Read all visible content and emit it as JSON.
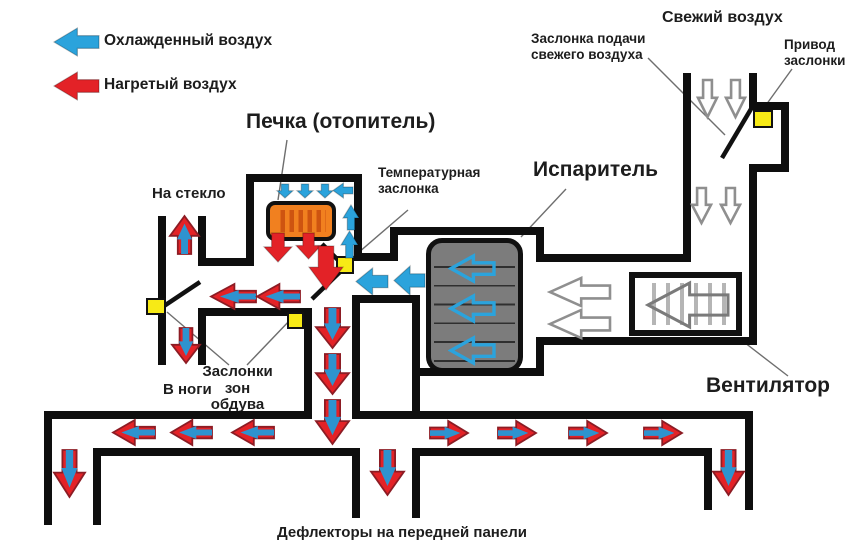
{
  "colors": {
    "wall": "#0e0e0e",
    "blue": "#2ba3dc",
    "red": "#e32227",
    "core_blue": "#2e93cf",
    "duo_edge": "#8c1c24",
    "yellow": "#f7ea16",
    "orange": "#f1801f",
    "orange_stripe": "#ce5410",
    "evap_gray": "#7c7c7c",
    "grille_gray": "#b5b5b5",
    "outline_gray": "#8f8f8f",
    "fan_arrow_gray": "#7a7a7a",
    "pointer_gray": "#6e6e6e",
    "flap_black": "#111111"
  },
  "legend": {
    "cold": "Охлажденный воздух",
    "hot": "Нагретый воздух"
  },
  "labels": {
    "heater_title": "Печка (отопитель)",
    "temp_damper": [
      "Температурная",
      "заслонка"
    ],
    "evaporator_title": "Испаритель",
    "fresh_air": "Свежий воздух",
    "fresh_damper": [
      "Заслонка подачи",
      "свежего воздуха"
    ],
    "actuator": [
      "Привод",
      "заслонки"
    ],
    "fan_title": "Вентилятор",
    "windshield": "На стекло",
    "feet": "В ноги",
    "zone_dampers": [
      "Заслонки",
      "зон",
      "обдува"
    ],
    "deflectors": "Дефлекторы на передней панели"
  },
  "diagram": {
    "walls": [
      [
        "duct-bottom-top-left",
        44,
        411,
        268,
        8
      ],
      [
        "duct-bottom-top-right",
        352,
        411,
        401,
        8
      ],
      [
        "duct-bottom-bottom-left",
        93,
        448,
        267,
        8
      ],
      [
        "duct-bottom-bottom-right",
        420,
        448,
        292,
        8
      ],
      [
        "duct-left-outer",
        44,
        411,
        8,
        114
      ],
      [
        "duct-left-inner",
        93,
        448,
        8,
        77
      ],
      [
        "vent-center-left",
        352,
        448,
        8,
        70
      ],
      [
        "vent-center-right",
        412,
        448,
        8,
        70
      ],
      [
        "vent-right-inner",
        704,
        448,
        8,
        62
      ],
      [
        "duct-right-outer",
        745,
        411,
        8,
        99
      ],
      [
        "column-left",
        304,
        308,
        8,
        111
      ],
      [
        "column-right",
        352,
        295,
        8,
        124
      ],
      [
        "windshield-duct-left",
        158,
        216,
        8,
        149
      ],
      [
        "windshield-duct-right",
        198,
        216,
        8,
        50
      ],
      [
        "heater-lip",
        198,
        258,
        56,
        8
      ],
      [
        "passage-bottom",
        198,
        308,
        114,
        8
      ],
      [
        "feet-duct-right",
        198,
        308,
        8,
        57
      ],
      [
        "heater-chamber-left",
        246,
        174,
        8,
        92
      ],
      [
        "heater-chamber-top",
        246,
        174,
        116,
        8
      ],
      [
        "heater-chamber-right",
        354,
        174,
        8,
        82
      ],
      [
        "evap-chamber-top",
        390,
        227,
        154,
        8
      ],
      [
        "evap-chamber-left-upper",
        390,
        227,
        8,
        34
      ],
      [
        "cold-channel-top",
        354,
        253,
        44,
        8
      ],
      [
        "cold-channel-bottom",
        352,
        295,
        68,
        8
      ],
      [
        "evap-chamber-left-lower",
        412,
        295,
        8,
        124
      ],
      [
        "evap-chamber-bottom",
        412,
        368,
        132,
        8
      ],
      [
        "step-upper-vert",
        536,
        227,
        8,
        35
      ],
      [
        "fan-passage-top",
        536,
        254,
        155,
        8
      ],
      [
        "step-lower-vert",
        536,
        337,
        8,
        39
      ],
      [
        "fan-passage-bottom",
        536,
        337,
        221,
        8
      ],
      [
        "fresh-duct-left",
        683,
        73,
        8,
        189
      ],
      [
        "fresh-duct-right-upper",
        749,
        73,
        8,
        37
      ],
      [
        "actuator-bump-top",
        749,
        102,
        40,
        8
      ],
      [
        "actuator-bump-right",
        781,
        102,
        8,
        70
      ],
      [
        "actuator-bump-bottom",
        753,
        164,
        36,
        8
      ],
      [
        "fresh-duct-right-lower",
        749,
        164,
        8,
        181
      ]
    ],
    "boxes": [
      [
        "temp-damper-box",
        336,
        256,
        18,
        18
      ],
      [
        "zone-damper-left-box",
        146,
        298,
        20,
        17
      ],
      [
        "zone-damper-right-box",
        287,
        312,
        17,
        17
      ],
      [
        "fresh-damper-actuator-box",
        753,
        110,
        20,
        18
      ]
    ],
    "lines": [
      [
        "flap",
        322,
        244,
        344,
        266
      ],
      [
        "flap",
        341,
        271,
        312,
        299
      ],
      [
        "flap",
        164,
        306,
        200,
        282
      ],
      [
        "flap",
        722,
        158,
        751,
        109
      ],
      [
        "pointer",
        287,
        140,
        278,
        200
      ],
      [
        "pointer",
        566,
        189,
        521,
        237
      ],
      [
        "pointer",
        408,
        210,
        351,
        259
      ],
      [
        "pointer",
        740,
        339,
        788,
        376
      ],
      [
        "pointer",
        648,
        58,
        725,
        135
      ],
      [
        "pointer",
        792,
        69,
        766,
        105
      ],
      [
        "pointer",
        229,
        365,
        167,
        312
      ],
      [
        "pointer",
        247,
        365,
        292,
        318
      ]
    ],
    "arrows": [
      [
        "legend-cold-arrow",
        54,
        28,
        45,
        28,
        "left",
        "blue"
      ],
      [
        "legend-hot-arrow",
        54,
        72,
        45,
        28,
        "left",
        "red"
      ],
      [
        "heater-inlet-arrow-1",
        277,
        184,
        16,
        14,
        "down",
        "blue"
      ],
      [
        "heater-inlet-arrow-2",
        297,
        184,
        16,
        14,
        "down",
        "blue"
      ],
      [
        "heater-inlet-arrow-3",
        317,
        184,
        16,
        14,
        "down",
        "blue"
      ],
      [
        "heater-top-left-arrow",
        333,
        183,
        20,
        15,
        "left",
        "blue"
      ],
      [
        "heater-rise-arrow-1",
        343,
        205,
        16,
        25,
        "up",
        "blue"
      ],
      [
        "heater-rise-arrow-2",
        341,
        231,
        17,
        27,
        "up",
        "blue"
      ],
      [
        "cold-out-arrow-1",
        394,
        266,
        31,
        29,
        "left",
        "blue"
      ],
      [
        "cold-out-arrow-2",
        356,
        268,
        32,
        27,
        "left",
        "blue"
      ],
      [
        "hot-out-arrow-1",
        264,
        233,
        28,
        29,
        "down",
        "red"
      ],
      [
        "hot-out-arrow-2",
        296,
        233,
        25,
        26,
        "down",
        "red"
      ],
      [
        "hot-column-arrow",
        309,
        246,
        34,
        44,
        "down",
        "red"
      ],
      [
        "mix-left-arrow-1",
        211,
        284,
        45,
        25,
        "left",
        "duo"
      ],
      [
        "mix-left-arrow-2",
        257,
        284,
        43,
        25,
        "left",
        "duo"
      ],
      [
        "windshield-arrow",
        170,
        216,
        29,
        38,
        "up",
        "duo"
      ],
      [
        "feet-arrow",
        172,
        328,
        28,
        35,
        "down",
        "duo"
      ],
      [
        "column-arrow-1",
        316,
        308,
        33,
        40,
        "down",
        "duo"
      ],
      [
        "column-arrow-2",
        316,
        354,
        33,
        40,
        "down",
        "duo"
      ],
      [
        "column-arrow-3",
        316,
        400,
        33,
        44,
        "down",
        "duo"
      ],
      [
        "duct-left-arrow-1",
        113,
        420,
        42,
        25,
        "left",
        "duo"
      ],
      [
        "duct-left-arrow-2",
        171,
        420,
        41,
        25,
        "left",
        "duo"
      ],
      [
        "duct-left-arrow-3",
        232,
        420,
        42,
        25,
        "left",
        "duo"
      ],
      [
        "duct-right-arrow-1",
        430,
        421,
        38,
        24,
        "right",
        "duo"
      ],
      [
        "duct-right-arrow-2",
        498,
        421,
        38,
        24,
        "right",
        "duo"
      ],
      [
        "duct-right-arrow-3",
        569,
        421,
        38,
        24,
        "right",
        "duo"
      ],
      [
        "duct-right-arrow-4",
        644,
        421,
        38,
        24,
        "right",
        "duo"
      ],
      [
        "vent-left-arrow",
        54,
        450,
        31,
        47,
        "down",
        "duo"
      ],
      [
        "vent-center-arrow",
        371,
        450,
        33,
        45,
        "down",
        "duo"
      ],
      [
        "vent-right-arrow",
        713,
        450,
        31,
        45,
        "down",
        "duo"
      ],
      [
        "fresh-in-arrow-1",
        698,
        80,
        19,
        37,
        "down",
        "outline"
      ],
      [
        "fresh-in-arrow-2",
        726,
        80,
        19,
        37,
        "down",
        "outline"
      ],
      [
        "fresh-down-arrow-1",
        692,
        188,
        19,
        35,
        "down",
        "outline"
      ],
      [
        "fresh-down-arrow-2",
        721,
        188,
        19,
        35,
        "down",
        "outline"
      ],
      [
        "blown-air-arrow-1",
        550,
        278,
        60,
        28,
        "left",
        "outline"
      ],
      [
        "blown-air-arrow-2",
        550,
        310,
        60,
        28,
        "left",
        "outline"
      ],
      [
        "fan-arrow",
        648,
        283,
        80,
        44,
        "left",
        "outline_clear"
      ],
      [
        "evap-flow-arrow-1",
        451,
        256,
        43,
        25,
        "left",
        "outline_blue"
      ],
      [
        "evap-flow-arrow-2",
        451,
        296,
        43,
        25,
        "left",
        "outline_blue"
      ],
      [
        "evap-flow-arrow-3",
        451,
        338,
        43,
        25,
        "left",
        "outline_blue"
      ]
    ]
  }
}
